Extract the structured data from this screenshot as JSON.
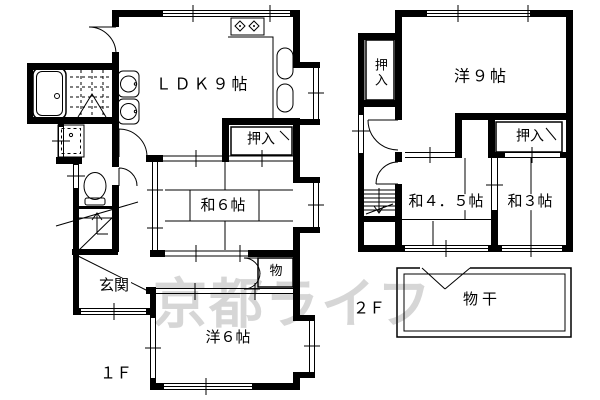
{
  "plan": {
    "watermark": "京都ライフ",
    "floor1": {
      "floor_label": "１Ｆ",
      "rooms": {
        "ldk": "ＬＤＫ９帖",
        "oshiire": "押入",
        "washitsu6": "和６帖",
        "storage": "物",
        "genkan": "玄関",
        "yoshitsu6": "洋６帖"
      }
    },
    "floor2": {
      "floor_label": "２Ｆ",
      "rooms": {
        "oshiire_left": "押入",
        "yoshitsu9": "洋９帖",
        "oshiire_right": "押入",
        "washitsu45": "和４．５帖",
        "washitsu3": "和３帖",
        "monohoshi": "物干"
      }
    },
    "colors": {
      "line": "#000000",
      "watermark": "#d6d6d6",
      "background": "#ffffff"
    }
  }
}
